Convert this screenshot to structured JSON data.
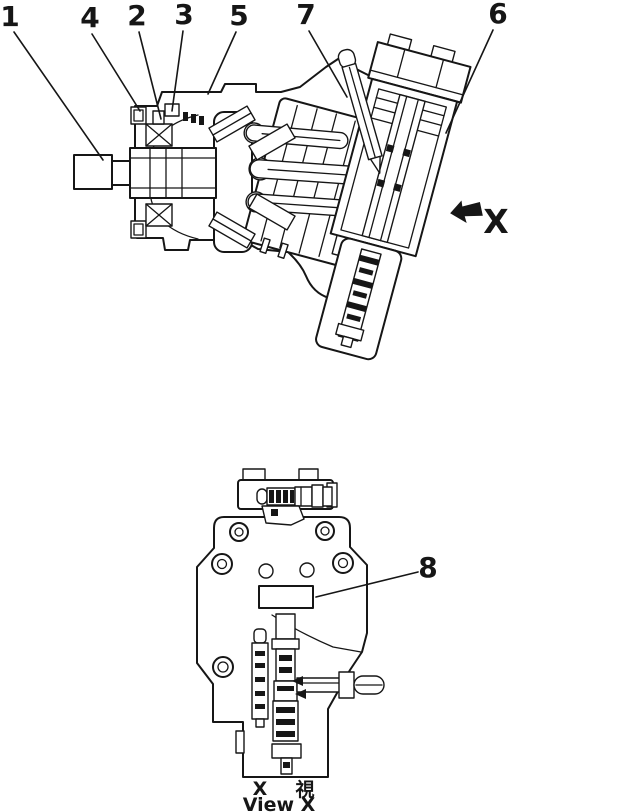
{
  "figure": {
    "background_color": "#ffffff",
    "line_color": "#161616",
    "callouts": [
      {
        "label": "1"
      },
      {
        "label": "2"
      },
      {
        "label": "3"
      },
      {
        "label": "4"
      },
      {
        "label": "5"
      },
      {
        "label": "6"
      },
      {
        "label": "7"
      },
      {
        "label": "8"
      }
    ],
    "direction_arrow": {
      "label": "X"
    },
    "view_caption": {
      "x": "X",
      "kanji": "視",
      "english": "View X"
    }
  }
}
